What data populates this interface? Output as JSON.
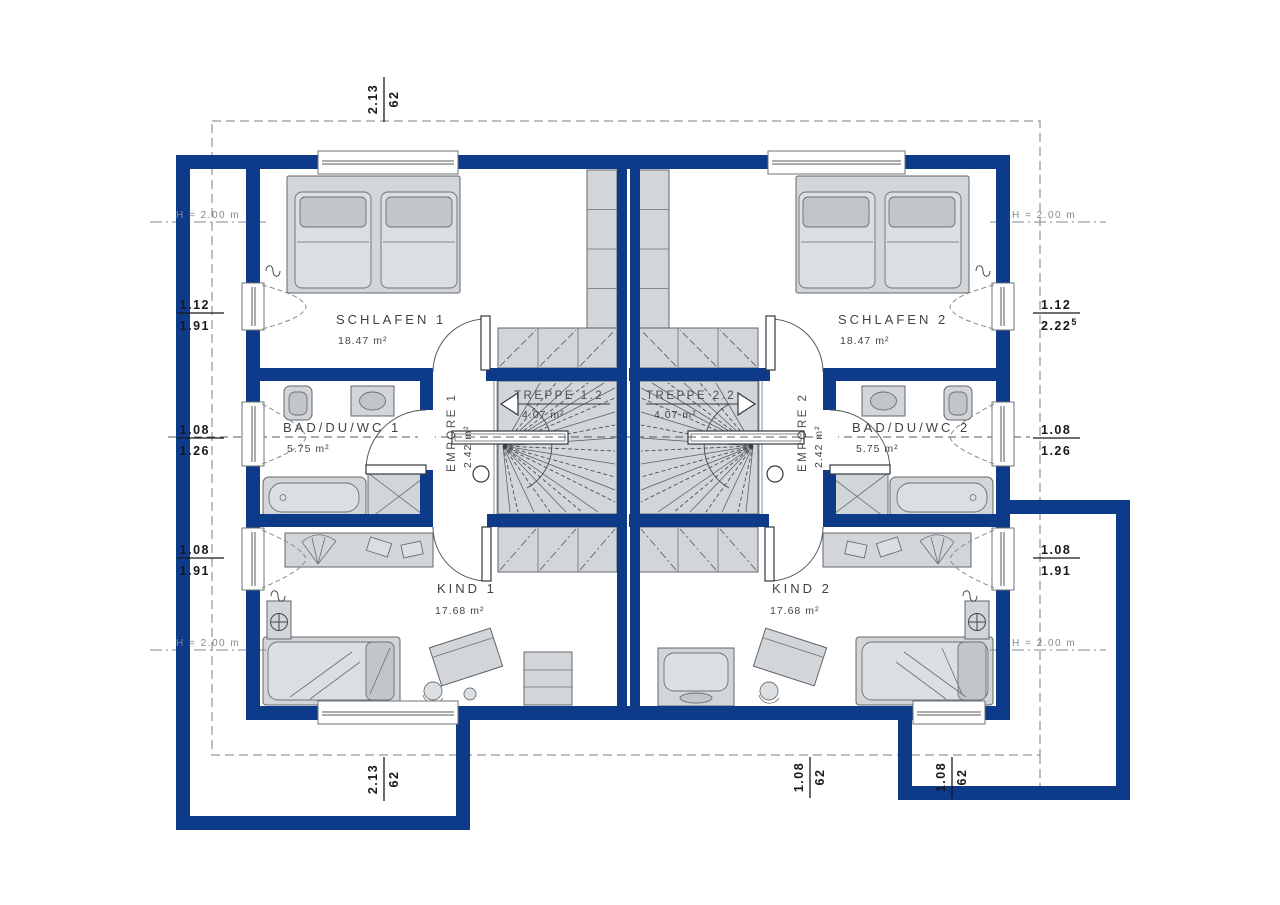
{
  "colors": {
    "wall": "#0d3b8a",
    "furn": "#d3d6d9",
    "dash": "#6f7377",
    "text": "#3f4347",
    "dim": "#17191b",
    "hlabel": "#83888d"
  },
  "labels": {
    "height": "H = 2.00 m"
  },
  "rooms": {
    "schlafen1": {
      "name": "SCHLAFEN 1",
      "area": "18.47 m²"
    },
    "schlafen2": {
      "name": "SCHLAFEN 2",
      "area": "18.47 m²"
    },
    "bad1": {
      "name": "BAD/DU/WC 1",
      "area": "5.75 m²"
    },
    "bad2": {
      "name": "BAD/DU/WC 2",
      "area": "5.75 m²"
    },
    "empore1": {
      "name": "EMPORE 1",
      "area": "2.42 m²"
    },
    "empore2": {
      "name": "EMPORE 2",
      "area": "2.42 m²"
    },
    "treppe1": {
      "name": "TREPPE 1.2",
      "area": "4.07 m²"
    },
    "treppe2": {
      "name": "TREPPE 2.2",
      "area": "4.07 m²"
    },
    "kind1": {
      "name": "KIND 1",
      "area": "17.68 m²"
    },
    "kind2": {
      "name": "KIND 2",
      "area": "17.68 m²"
    }
  },
  "dims": {
    "top": {
      "a": "2.13",
      "b": "62"
    },
    "left1": {
      "a": "1.12",
      "b": "1.91"
    },
    "left2": {
      "a": "1.08",
      "b": "1.26"
    },
    "left3": {
      "a": "1.08",
      "b": "1.91"
    },
    "right1": {
      "a": "1.12",
      "b": "2.22",
      "sup": "5"
    },
    "right2": {
      "a": "1.08",
      "b": "1.26"
    },
    "right3": {
      "a": "1.08",
      "b": "1.91"
    },
    "bottom1": {
      "a": "2.13",
      "b": "62"
    },
    "bottom2": {
      "a": "1.08",
      "b": "62"
    },
    "bottom3": {
      "a": "1.08",
      "b": "62"
    }
  }
}
